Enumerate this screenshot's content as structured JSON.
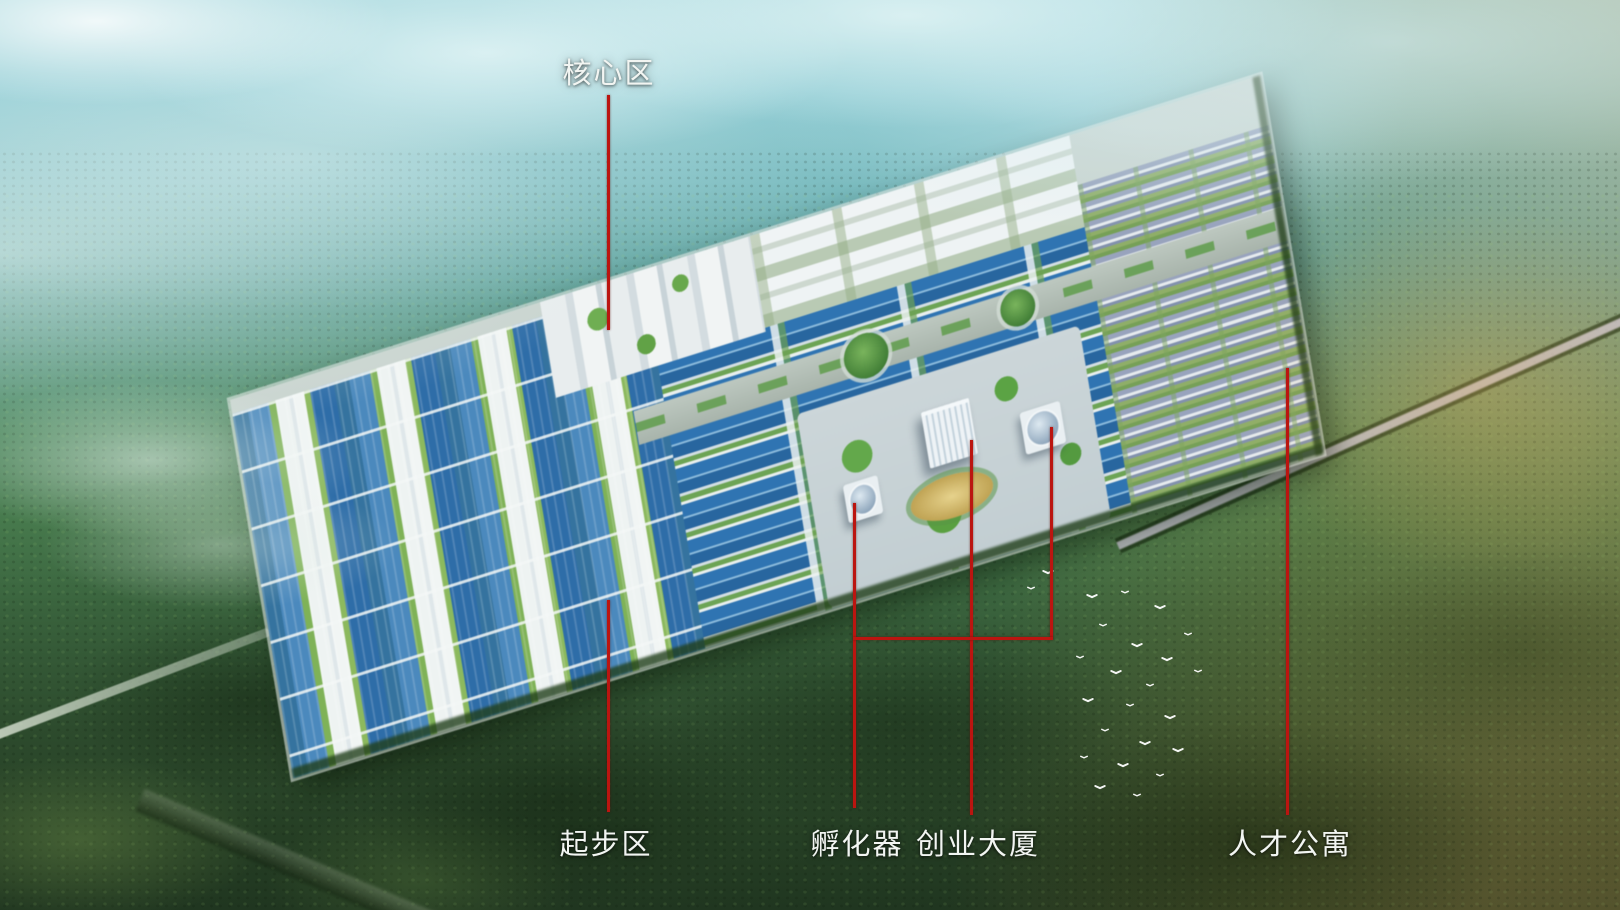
{
  "annotations": {
    "core_area": {
      "label": "核心区"
    },
    "starter_area": {
      "label": "起步区"
    },
    "incubator": {
      "label": "孵化器"
    },
    "startup_tower": {
      "label": "创业大厦"
    },
    "talent_apartments": {
      "label": "人才公寓"
    }
  },
  "icons": {
    "bird": "white v-shape silhouette"
  },
  "palette": {
    "leader_line_red": "#bb1510",
    "label_text": "#f2f5f2",
    "factory_roof_blue": "#2f74b2",
    "building_white": "#eef3f4",
    "park_ground": "#c9d4cf",
    "forest_dark_green": "#2d4b2d",
    "haze_cyan": "#a3d6dc",
    "haze_orange": "#f0af55"
  }
}
